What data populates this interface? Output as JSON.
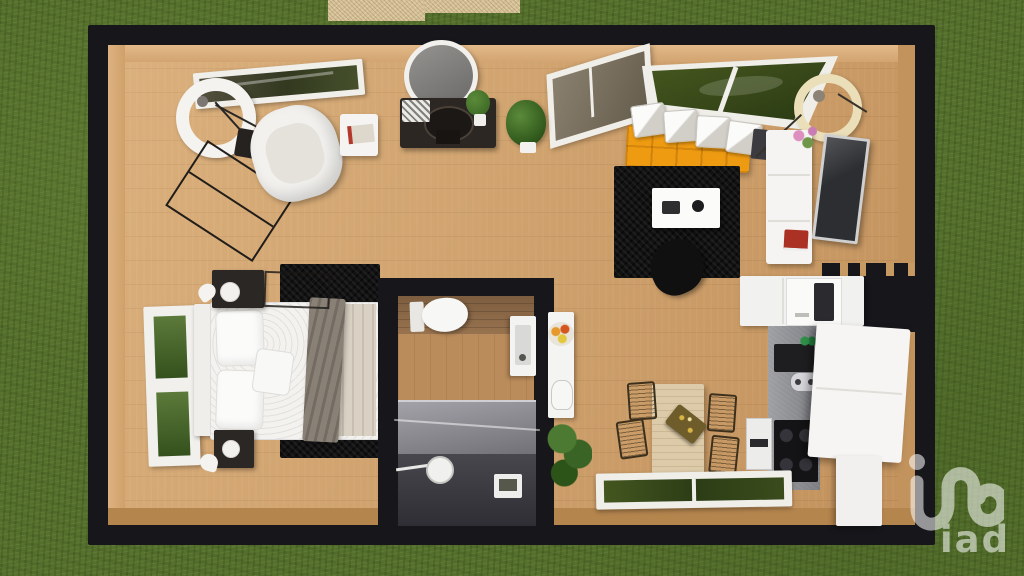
{
  "watermark": {
    "brand": "iad",
    "icon": "iad-loop-logo",
    "color": "#ffffff"
  },
  "scene": {
    "type": "3d-floor-plan-top-view",
    "setting": {
      "ground": "grass-lawn",
      "outside_feature": "gravel-terrace-patch",
      "plan_shape": "rectangular-studio"
    },
    "palette": {
      "grass": "#56712d",
      "wall": "#17161a",
      "floor_wood": "#cfa06a",
      "sofa_orange": "#ee9b12",
      "rug_black": "#121212",
      "furniture_white": "#f5f4f2",
      "counter_gray": "#8d8e93",
      "plant_green": "#3f6d28",
      "dining_wood": "#dccaa8",
      "terrace_gravel": "#d6c095",
      "shower_gray": "#44444a"
    },
    "rooms": {
      "living_area": {
        "name": "living area",
        "furniture": [
          "ring-floor-lamp",
          "white-armchair",
          "side-table-with-book",
          "metal-clothes-rack",
          "angled-window",
          "oval-mirror",
          "black-console-table",
          "potted-plant",
          "entry-door",
          "corner-window",
          "orange-sofa-with-white-cushions",
          "cream-arc-floor-lamp",
          "white-media-console",
          "flowers",
          "red-books",
          "television",
          "black-shag-rug",
          "white-coffee-table",
          "black-lounge-chair",
          "slat-divider"
        ]
      },
      "bedroom": {
        "name": "bedroom",
        "furniture": [
          "double-bed",
          "white-headboard",
          "pillows",
          "accent-cushion",
          "beige-blanket",
          "gray-throw",
          "nightstand-top",
          "nightstand-bottom",
          "white-table-lamps",
          "black-shag-rug",
          "tall-window"
        ]
      },
      "bathroom": {
        "name": "bathroom",
        "furniture": [
          "wall-hung-toilet",
          "washbasin-with-mirror",
          "walk-in-shower",
          "rain-shower-head",
          "shower-tray"
        ]
      },
      "kitchen_dining": {
        "name": "kitchen / dining",
        "furniture": [
          "upper-cabinets",
          "microwave",
          "concrete-counter",
          "sink-with-faucet",
          "green-bottles",
          "gas-cooktop",
          "dishwasher",
          "white-kitchen-island",
          "island-cart",
          "fridge-cabinet",
          "fruit-bowl",
          "kettle",
          "potted-plant",
          "dining-table",
          "gold-centerpiece",
          "wire-dining-chairs",
          "bottom-window"
        ]
      }
    }
  }
}
